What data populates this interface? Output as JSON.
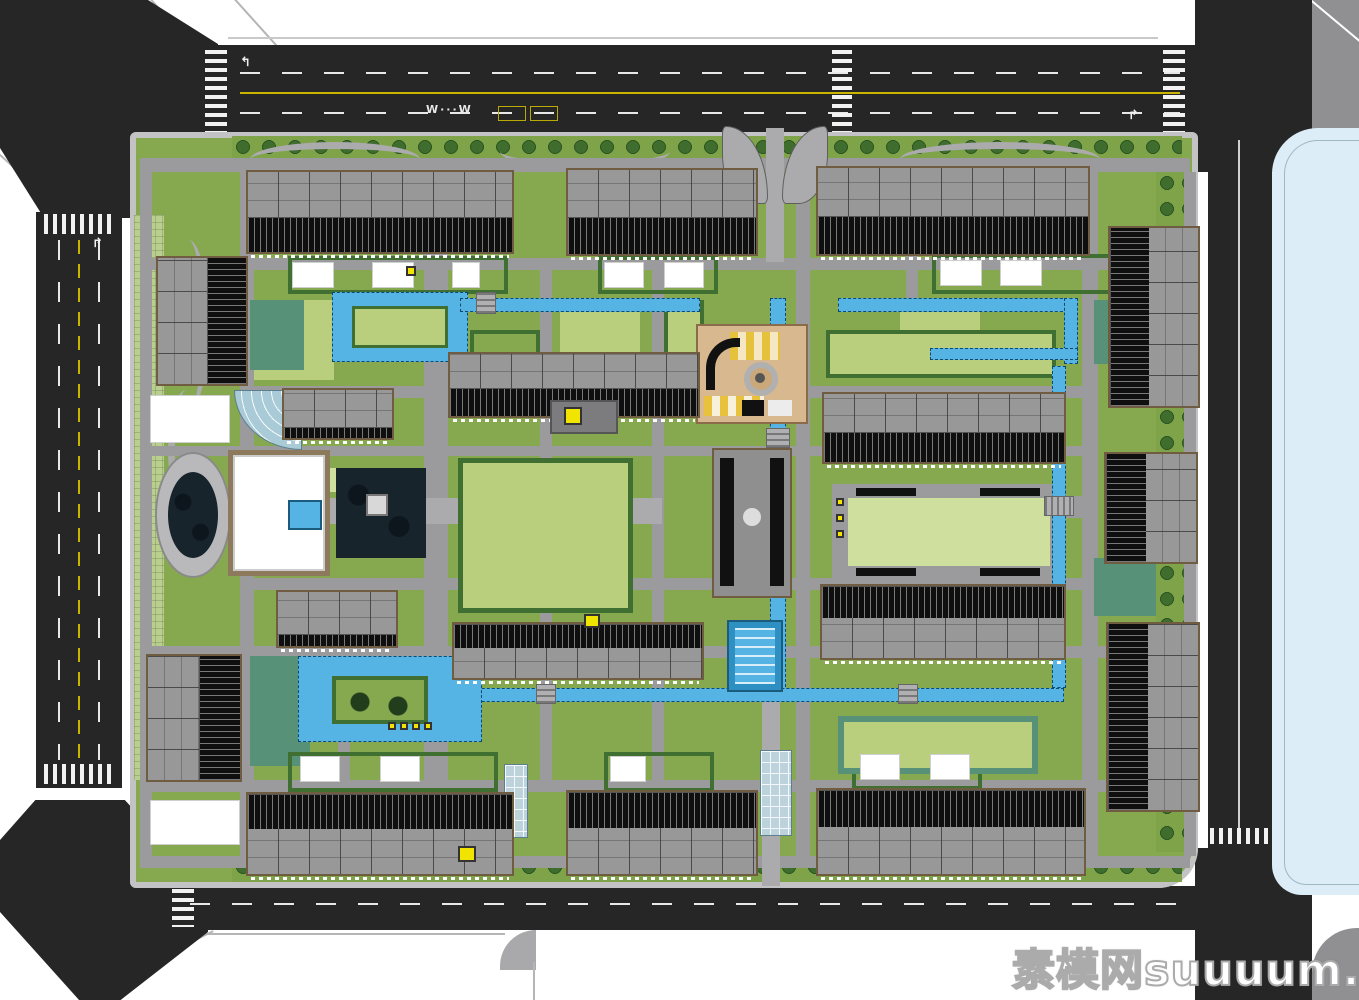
{
  "watermark": {
    "text": "素模网suuuum.com"
  },
  "road_markings": {
    "bus_label": "W···W",
    "turn_arrow": "↱",
    "turn_arrow_left": "↰"
  },
  "colors": {
    "road": "#262626",
    "roadline": "#e8e8e8",
    "yellow": "#c9b500",
    "sidewalk": "#c3c3c5",
    "path": "#9b9b9d",
    "plaza": "#ababad",
    "lawn": "#86a84e",
    "lawnLight": "#b9cf7d",
    "lawnPale": "#cfdf9e",
    "lawnDark": "#3f7031",
    "teal": "#579178",
    "canal": "#56b4e4",
    "water": "#17242c",
    "parcel": "#dcedf8",
    "roof": "#949494",
    "roofBorder": "#6f5c41",
    "facade": "#0f0f0f",
    "sand": "#d8b88e",
    "accent": "#f0e400",
    "glass": "#bcd3dc",
    "white": "#ffffff"
  },
  "scene": {
    "type": "residential-master-plan-top-view",
    "site": {
      "bounded_by_roads": true,
      "adjacent_blue_parcel_east": true
    },
    "inventory": {
      "top_row_slab_buildings": 3,
      "bottom_row_slab_buildings": 3,
      "west_tower_buildings": 2,
      "east_tower_buildings": 3,
      "central_slab_buildings": 6,
      "water_canals": true,
      "central_lake": true,
      "lap_pool": true,
      "playground": true,
      "west_entrance_oval_plaza": true,
      "north_entrance_petal_plaza": true,
      "glass_canopies": 2,
      "crosswalks": 7
    }
  }
}
